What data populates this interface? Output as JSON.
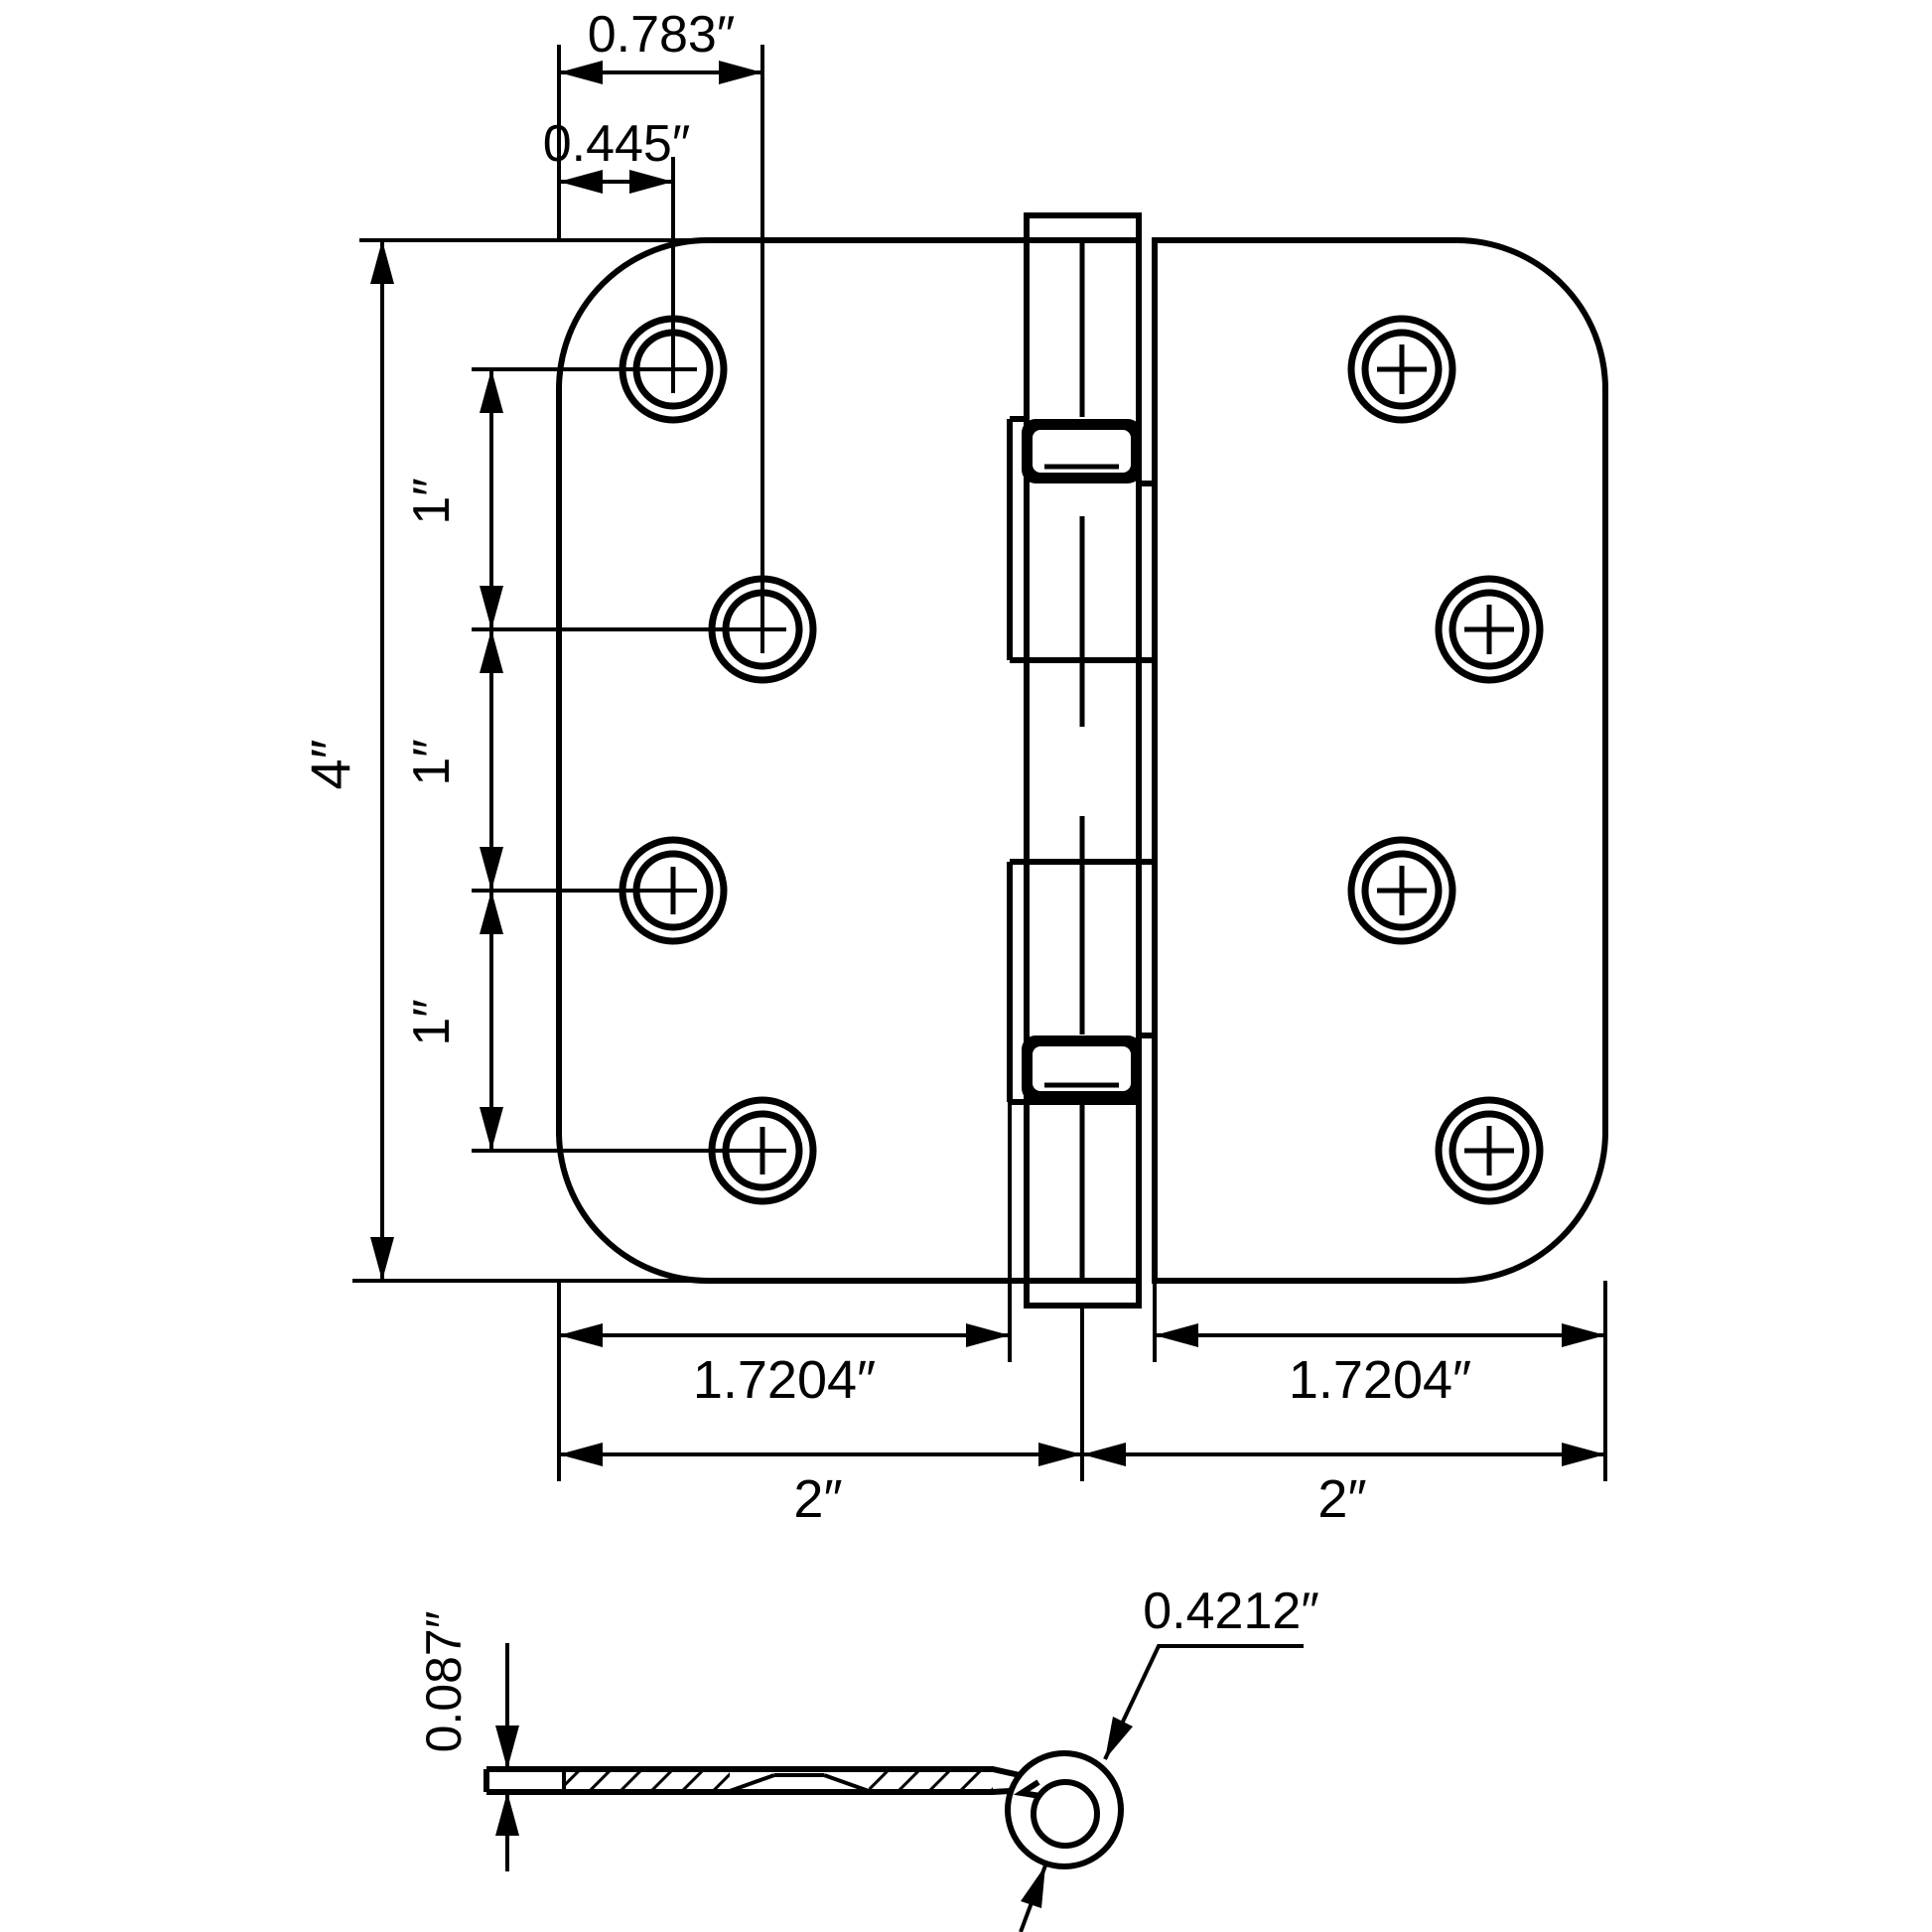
{
  "front_view": {
    "dim_top_outer": "0.783″",
    "dim_top_inner": "0.445″",
    "dim_height": "4″",
    "dim_row_spacing": [
      "1″",
      "1″",
      "1″"
    ],
    "dim_leaf_flat_left": "1.7204″",
    "dim_leaf_flat_right": "1.7204″",
    "dim_leaf_width_left": "2″",
    "dim_leaf_width_right": "2″"
  },
  "side_view": {
    "dim_thickness": "0.087″",
    "dim_knuckle_diameter": "0.4212″"
  }
}
